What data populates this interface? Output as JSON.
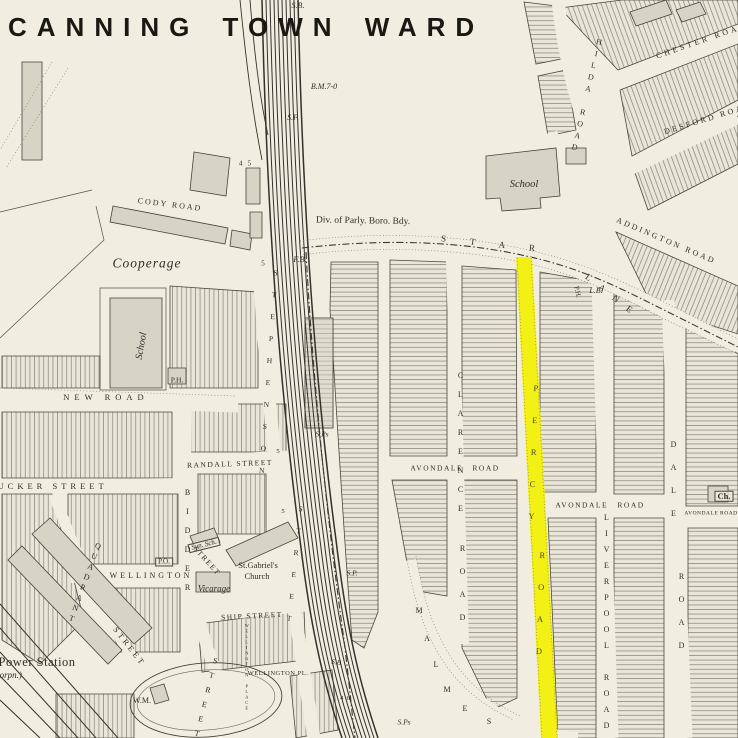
{
  "title": "CANNING TOWN WARD",
  "highlight": {
    "road": "PERCY ROAD",
    "color": "#f3f000"
  },
  "labels": [
    {
      "text": "S.B."
    },
    {
      "text": "B.M.7-0"
    },
    {
      "text": "S.P."
    },
    {
      "text": "F.B."
    },
    {
      "text": "4   5"
    },
    {
      "text": "5"
    },
    {
      "text": "CODY ROAD"
    },
    {
      "text": "Cooperage"
    },
    {
      "text": "Div. of Parly. Boro. Bdy."
    },
    {
      "text": "STAR"
    },
    {
      "text": "LANE"
    },
    {
      "text": "ADDINGTON ROAD"
    },
    {
      "text": "CHESTER ROAD"
    },
    {
      "text": "DESFORD ROAD"
    },
    {
      "text": "HILDA ROAD"
    },
    {
      "text": "School"
    },
    {
      "text": "School"
    },
    {
      "text": "P.H."
    },
    {
      "text": "NEW ROAD"
    },
    {
      "text": "TUCKER STREET"
    },
    {
      "text": "RANDALL STREET"
    },
    {
      "text": "QUADRANT"
    },
    {
      "text": "STREET"
    },
    {
      "text": "WELLINGTON"
    },
    {
      "text": "P.O."
    },
    {
      "text": "Sun. Sch."
    },
    {
      "text": "STREET"
    },
    {
      "text": "BIDDER"
    },
    {
      "text": "STREET"
    },
    {
      "text": "St.Gabriel's"
    },
    {
      "text": "Church"
    },
    {
      "text": "Vicarage"
    },
    {
      "text": "SHIP STREET"
    },
    {
      "text": "WELLINGTON PL."
    },
    {
      "text": "WELLINGTON PLACE"
    },
    {
      "text": "The Power Station"
    },
    {
      "text": "(West Ham Corpn.)"
    },
    {
      "text": "W.M."
    },
    {
      "text": "S.Ps"
    },
    {
      "text": "S.Ps"
    },
    {
      "text": "S.B."
    },
    {
      "text": "4  6"
    },
    {
      "text": "PERCY"
    },
    {
      "text": "ROAD"
    },
    {
      "text": "CLARENCE"
    },
    {
      "text": "ROAD"
    },
    {
      "text": "AVONDALE ROAD"
    },
    {
      "text": "AVONDALE ROAD"
    },
    {
      "text": "AVONDALE ROAD"
    },
    {
      "text": "Ch."
    },
    {
      "text": "LIVERPOOL ROAD"
    },
    {
      "text": "DALE"
    },
    {
      "text": "ROAD"
    },
    {
      "text": "M"
    },
    {
      "text": "A"
    },
    {
      "text": "L"
    },
    {
      "text": "M"
    },
    {
      "text": "E"
    },
    {
      "text": "S"
    },
    {
      "text": "STEPHENSON"
    },
    {
      "text": "STREET"
    },
    {
      "text": "P.H."
    },
    {
      "text": "L.B."
    },
    {
      "text": "5"
    },
    {
      "text": "5"
    },
    {
      "text": "S.P."
    }
  ]
}
